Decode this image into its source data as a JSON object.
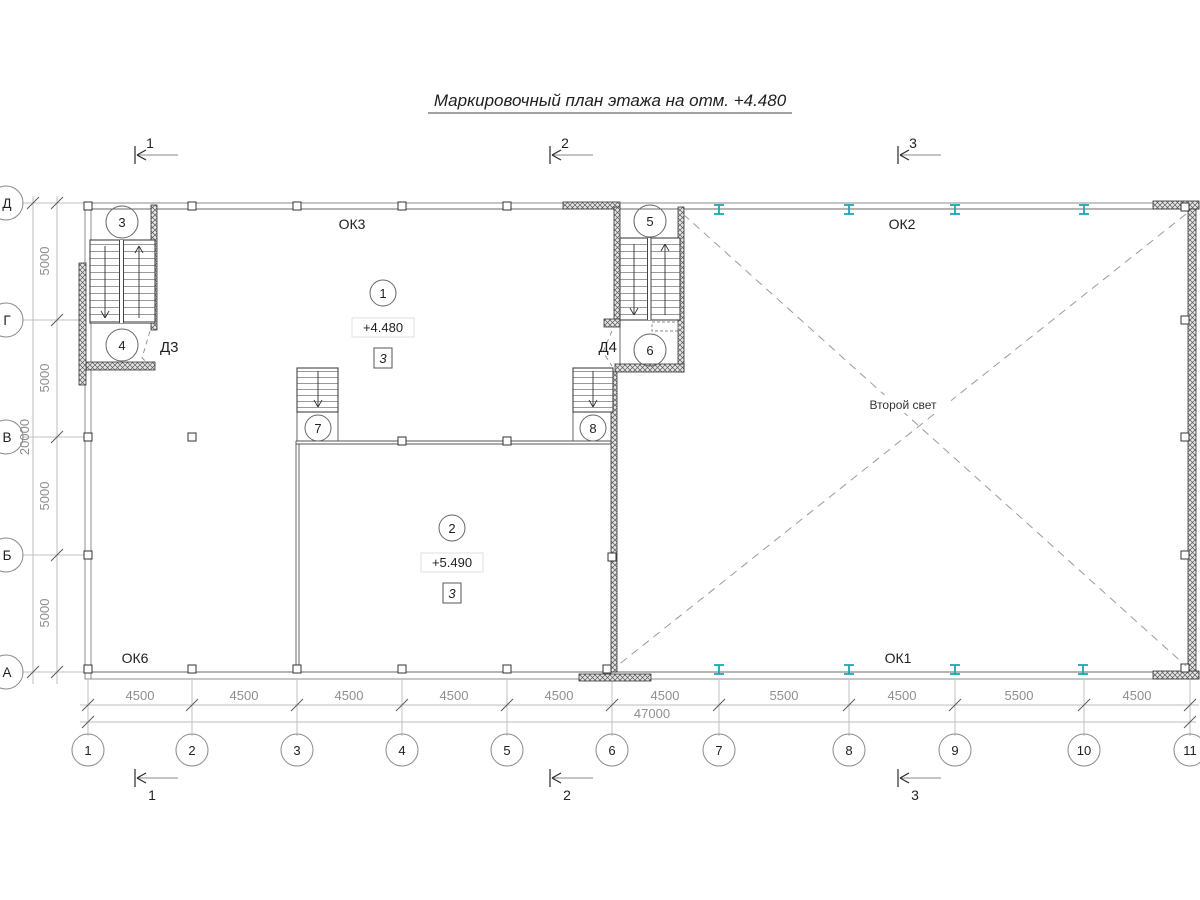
{
  "title": "Маркировочный план этажа на отм. +4.480",
  "sections": {
    "top": [
      "1",
      "2",
      "3"
    ],
    "bottom": [
      "1",
      "2",
      "3"
    ]
  },
  "axes": {
    "rows": [
      "Д",
      "Г",
      "В",
      "Б",
      "А"
    ],
    "cols": [
      "1",
      "2",
      "3",
      "4",
      "5",
      "6",
      "7",
      "8",
      "9",
      "10",
      "11"
    ]
  },
  "dims": {
    "left_segments": [
      "5000",
      "5000",
      "5000",
      "5000"
    ],
    "left_total": "20000",
    "bottom_segments": [
      "4500",
      "4500",
      "4500",
      "4500",
      "4500",
      "4500",
      "5500",
      "4500",
      "5500",
      "4500"
    ],
    "bottom_total": "47000"
  },
  "stairs": {
    "p3": "3",
    "p4": "4",
    "p5": "5",
    "p6": "6",
    "p7": "7",
    "p8": "8"
  },
  "doors": {
    "d3": "Д3",
    "d4": "Д4"
  },
  "rooms": {
    "r1_num": "1",
    "r1_elev": "+4.480",
    "r1_type": "3",
    "r2_num": "2",
    "r2_elev": "+5.490",
    "r2_type": "3"
  },
  "windows": {
    "ok1": "ОК1",
    "ok2": "ОК2",
    "ok3": "ОК3",
    "ok6": "ОК6"
  },
  "void_label": "Второй свет",
  "colors": {
    "steel": "#18a7b5"
  }
}
